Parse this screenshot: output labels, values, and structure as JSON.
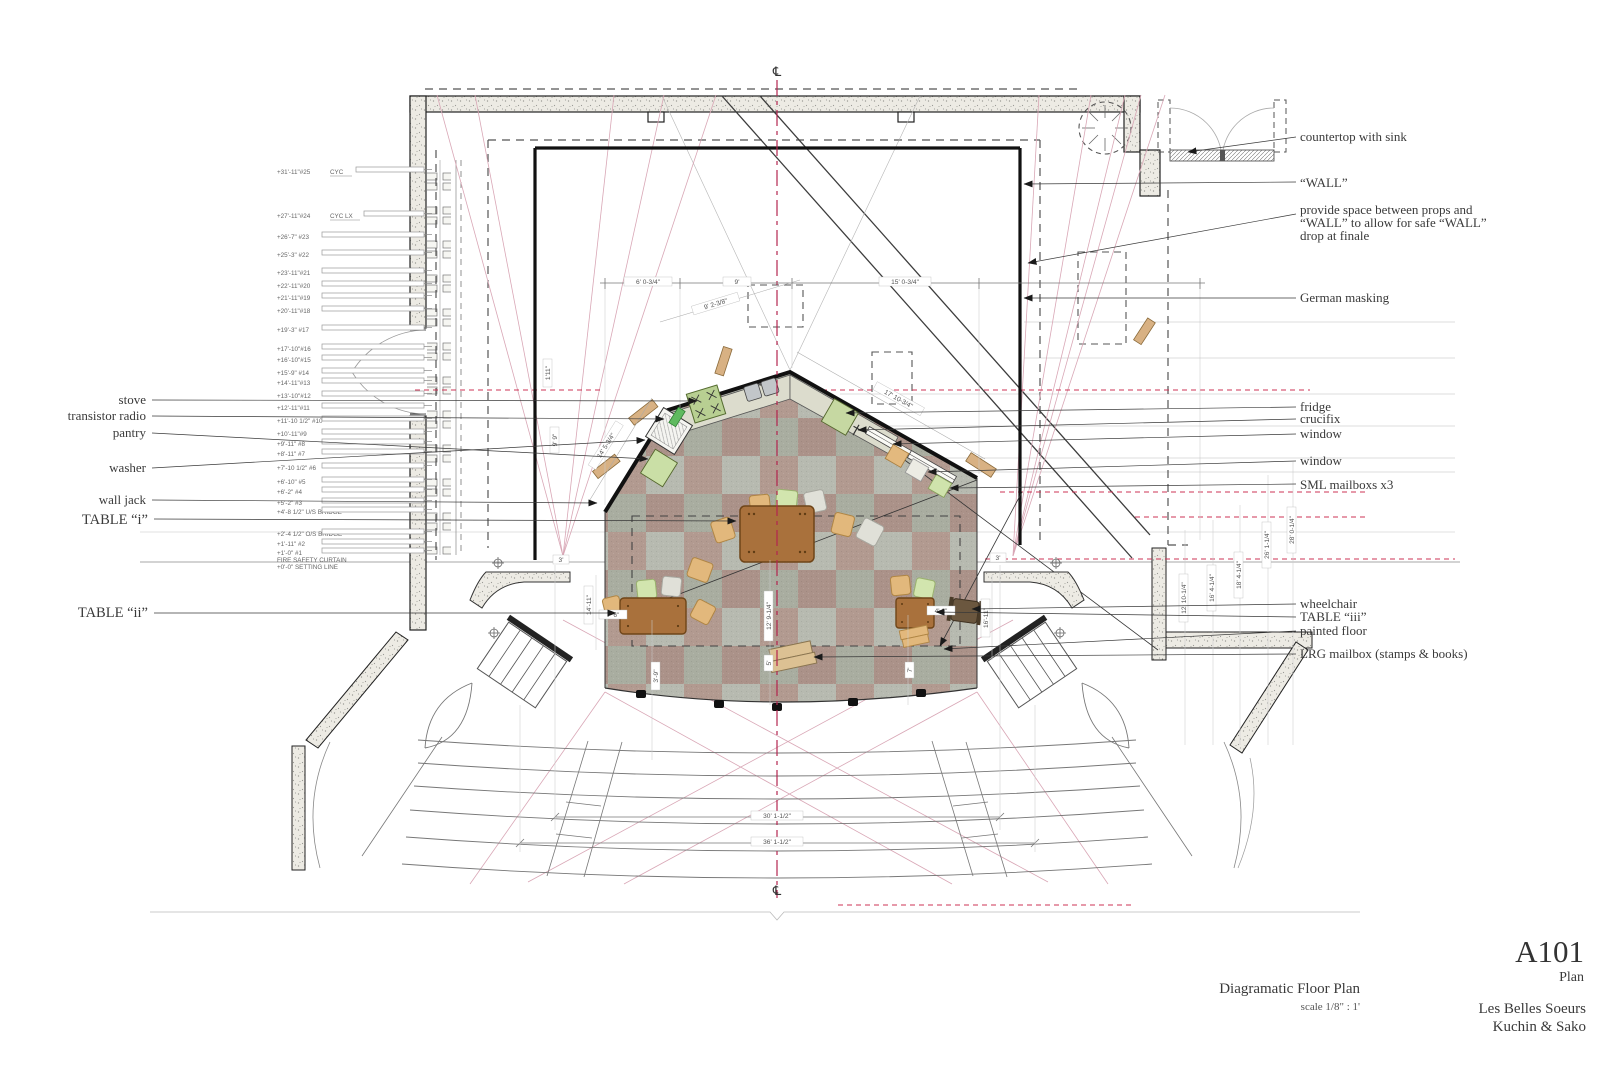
{
  "title_block": {
    "sheet_number": "A101",
    "sheet_name": "Plan",
    "show_title": "Les Belles Soeurs",
    "designers": "Kuchin & Sako",
    "drawing_title": "Diagramatic Floor Plan",
    "drawing_scale": "scale 1/8\" : 1'"
  },
  "centerline_symbol": "℄",
  "line_sets": [
    "+31'-11\"#25",
    "+27'-11\"#24",
    "+26'-7\" #23",
    "+25'-3\" #22",
    "+23'-11\"#21",
    "+22'-11\"#20",
    "+21'-11\"#19",
    "+20'-11\"#18",
    "+19'-3\" #17",
    "+17'-10\"#16",
    "+16'-10\"#15",
    "+15'-9\" #14",
    "+14'-11\"#13",
    "+13'-10\"#12",
    "+12'-11\"#11",
    "+11'-10 1/2\" #10",
    "+10'-11\"#9",
    "+9'-11\" #8",
    "+8'-11\" #7",
    "+7'-10 1/2\" #6",
    "+6'-10\" #5",
    "+6'-2\" #4",
    "+5'-2\" #3",
    "+4'-8 1/2\" U/S BRIDGE",
    "+2'-4 1/2\" O/S BRIDGE",
    "+1'-11\" #2",
    "+1'-0\" #1",
    "FIRE SAFETY CURTAIN",
    "+0'-0\"  SETTING LINE"
  ],
  "line_set_extras": {
    "cyc": "CYC",
    "cyc_lx": "CYC LX"
  },
  "left_labels": {
    "stove": "stove",
    "transistor_radio": "transistor radio",
    "pantry": "pantry",
    "washer": "washer",
    "wall_jack": "wall jack",
    "table_i": "TABLE “i”",
    "table_ii": "TABLE “ii”"
  },
  "right_labels": {
    "countertop": "countertop with sink",
    "wall": "“WALL”",
    "prop_note_1": "provide space between props and",
    "prop_note_2": "“WALL” to allow for safe “WALL”",
    "prop_note_3": "drop at finale",
    "german_masking": "German masking",
    "fridge": "fridge",
    "crucifix": "crucifix",
    "window_1": "window",
    "window_2": "window",
    "sml_mailboxes": "SML mailboxs x3",
    "wheelchair": "wheelchair",
    "table_iii": "TABLE “iii”",
    "painted_floor": "painted floor",
    "lrg_mailbox": "LRG mailbox (stamps & books)"
  },
  "dims": {
    "d1": "6' 0-3/4\"",
    "d2": "9'",
    "d3": "15' 0-3/4\"",
    "d4": "9' 2-3/8\"",
    "d5": "17' 10-3/4\"",
    "d6": "14' 5-3/4\"",
    "d7": "1'11\"",
    "d8": "9' 9\"",
    "d9": "3'",
    "d10": "3'",
    "d11": "7' 6\"",
    "d12": "4' 1\"",
    "d13": "12' 9-1/4\"",
    "d14": "5'",
    "d15": "3'-9\"",
    "d16": "7'",
    "d17": "14'-11\"",
    "d18": "16'-11\"",
    "d19": "30' 1-1/2\"",
    "d20": "36' 1-1/2\"",
    "d21": "12' 10-1/4\"",
    "d22": "16' 4-1/4\"",
    "d23": "18' 4-1/4\"",
    "d24": "26' 1-1/4\"",
    "d25": "28' 0-1/4\""
  },
  "colors": {
    "centerline_red": "#b3254f",
    "sightline_pink": "#d9a7b6",
    "prop_red": "#cc3355",
    "floor_gray": "#b6b9ad",
    "floor_brown": "#b29a90",
    "table_brown": "#a9713c",
    "chair_tan": "#e2b87c",
    "chair_green": "#d2e5ae",
    "counter": "#dcdccd",
    "appliance_green": "#c6d8a2"
  }
}
